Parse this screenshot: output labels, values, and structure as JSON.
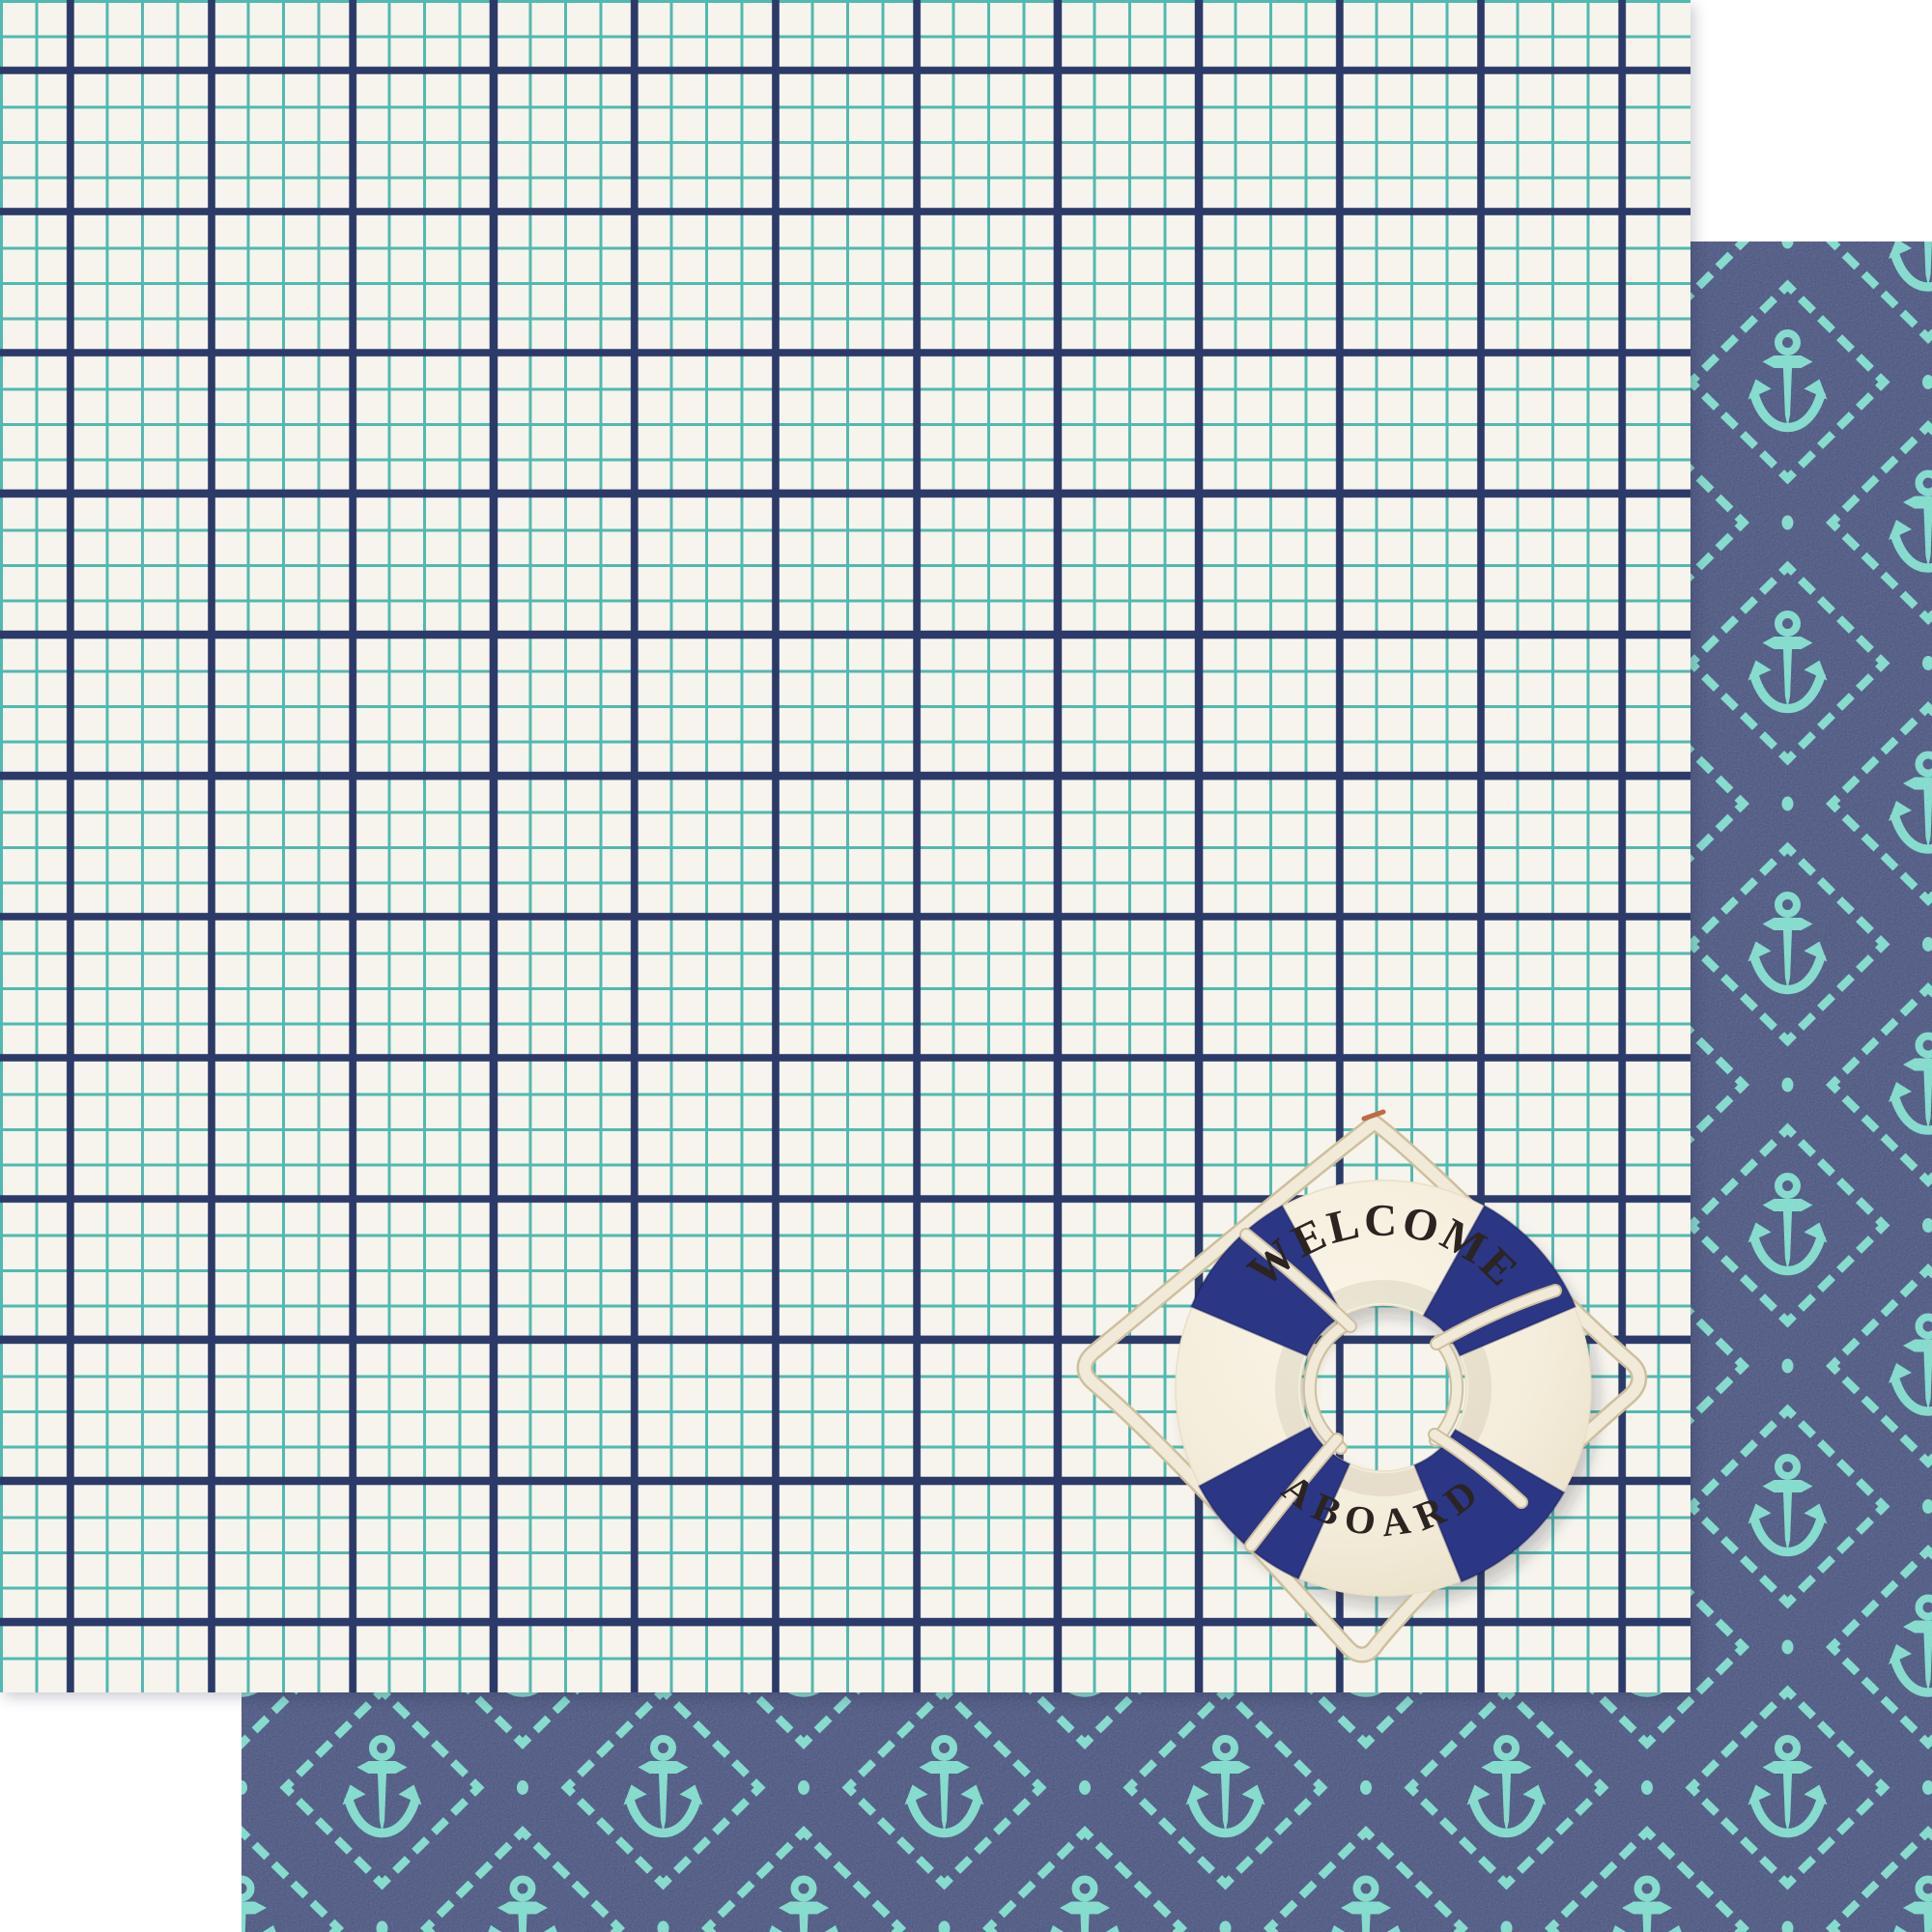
{
  "scene": {
    "description": "double-sided nautical scrapbook paper: cream windowpane-grid sheet overlapping navy anchor-argyle sheet, with a welcome-aboard life ring"
  },
  "life_ring": {
    "top_text": "WELCOME",
    "bottom_text": "ABOARD"
  },
  "palette": {
    "page-bg": "#ffffff",
    "paper-cream": "#f6f4ec",
    "grid-teal": "#51b9b1",
    "grid-navy": "#2c3a69",
    "back-navy": "#3e4976",
    "motif-teal": "#74d6c6",
    "patch-navy": "#2b3684",
    "ring-hi": "#faf5e7",
    "ring-mid": "#f4eddb",
    "ring-lo": "#e9dfc6",
    "rope": "#f1ead8",
    "rope-shadow": "#cebf9d",
    "text-black": "#2b2420",
    "thread-accent": "#c06a43"
  }
}
